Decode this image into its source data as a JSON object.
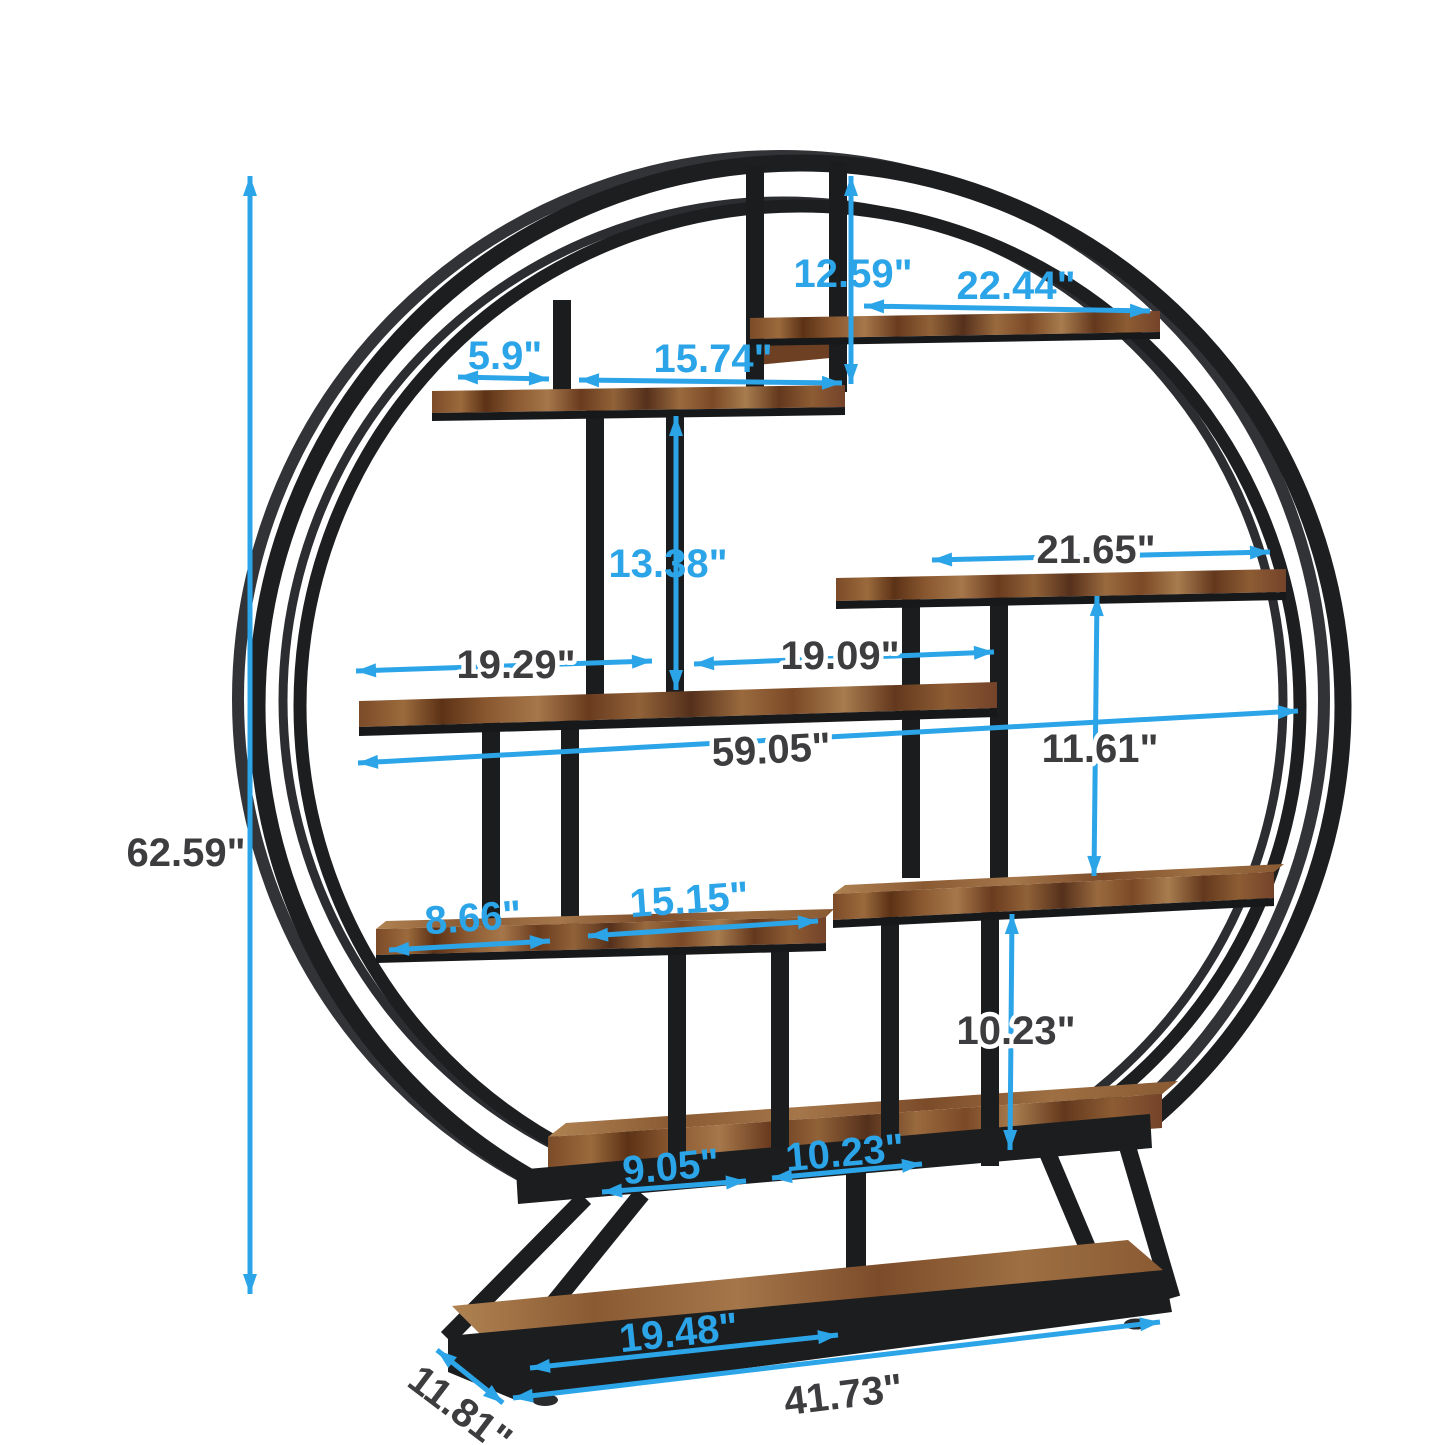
{
  "image": {
    "type": "product-dimension-diagram",
    "subject": "round industrial etagere bookshelf with staggered wood shelves on trapezoid base",
    "background": "#ffffff",
    "unit": "inches"
  },
  "colors": {
    "dimension_blue": "#2ca4e8",
    "label_dark": "#3d3d3f",
    "metal_black": "#1c1d1f",
    "wood_brown": "#8a5a33"
  },
  "labels": {
    "overall_height": "62.59\"",
    "top_clearance": "12.59\"",
    "top_shelf_length": "22.44\"",
    "upper_left_gap": "5.9\"",
    "upper_shelf_length": "15.74\"",
    "mid_clearance": "13.38\"",
    "right_shelf_length": "21.65\"",
    "mid_left_span": "19.29\"",
    "mid_right_span": "19.09\"",
    "total_shelf_width": "59.05\"",
    "right_clearance_upper": "11.61\"",
    "right_clearance_lower": "10.23\"",
    "lower_left_gap": "8.66\"",
    "lower_shelf_length": "15.15\"",
    "bottom_left_span": "9.05\"",
    "bottom_right_span": "10.23\"",
    "base_shelf_length": "19.48\"",
    "base_width": "41.73\"",
    "base_depth": "11.81\""
  }
}
